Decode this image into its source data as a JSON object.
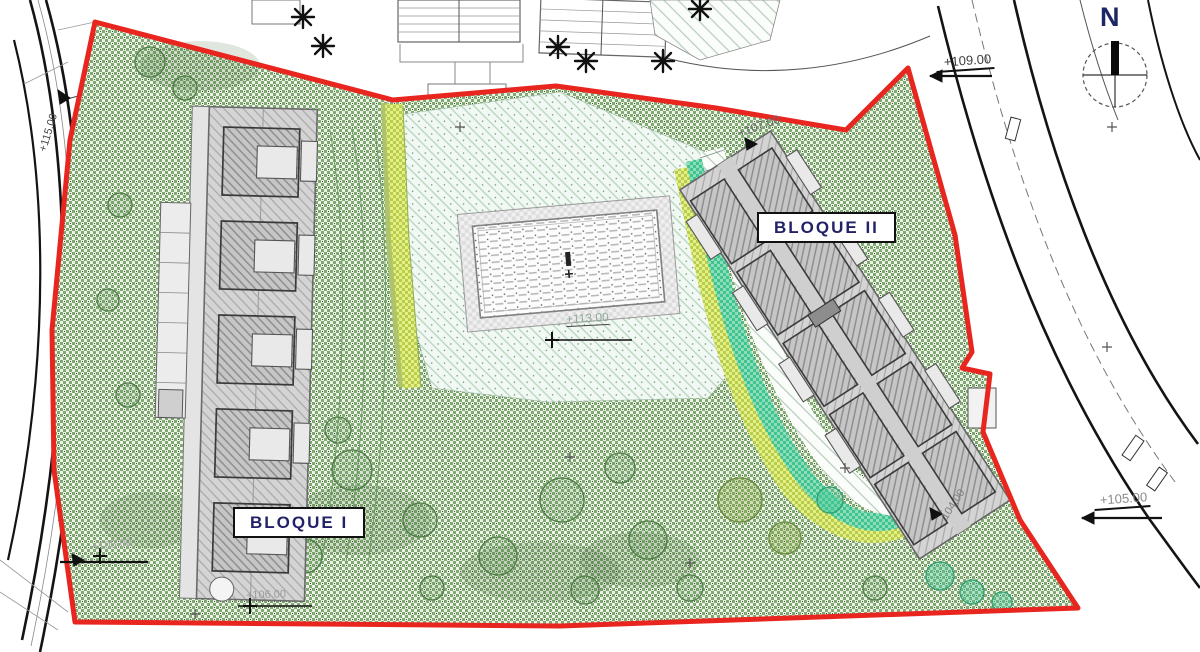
{
  "page": {
    "type": "architectural site plan"
  },
  "labels": {
    "bloque_i": "BLOQUE I",
    "bloque_ii": "BLOQUE II"
  },
  "compass": {
    "north": "N"
  },
  "elevations": [
    {
      "name": "road-west",
      "text": "+115.00"
    },
    {
      "name": "road-north-east",
      "text": "+109.00"
    },
    {
      "name": "terrace-north-east",
      "text": "+107.00"
    },
    {
      "name": "pool-terrace",
      "text": "+113.00"
    },
    {
      "name": "slope-east",
      "text": "104.00"
    },
    {
      "name": "road-south-east",
      "text": "+105.00"
    },
    {
      "name": "path-south-west",
      "text": "+106.00"
    },
    {
      "name": "road-south-west",
      "text": "+105.00"
    }
  ],
  "colors": {
    "boundary_red": "#e8251f",
    "garden_green": "#7fa873",
    "pool_deck_mint": "#e8f3ea",
    "path_yellow": "#cfe06a",
    "water_teal": "#3ec491",
    "building_gray": "#cccccc",
    "label_navy": "#232268"
  }
}
